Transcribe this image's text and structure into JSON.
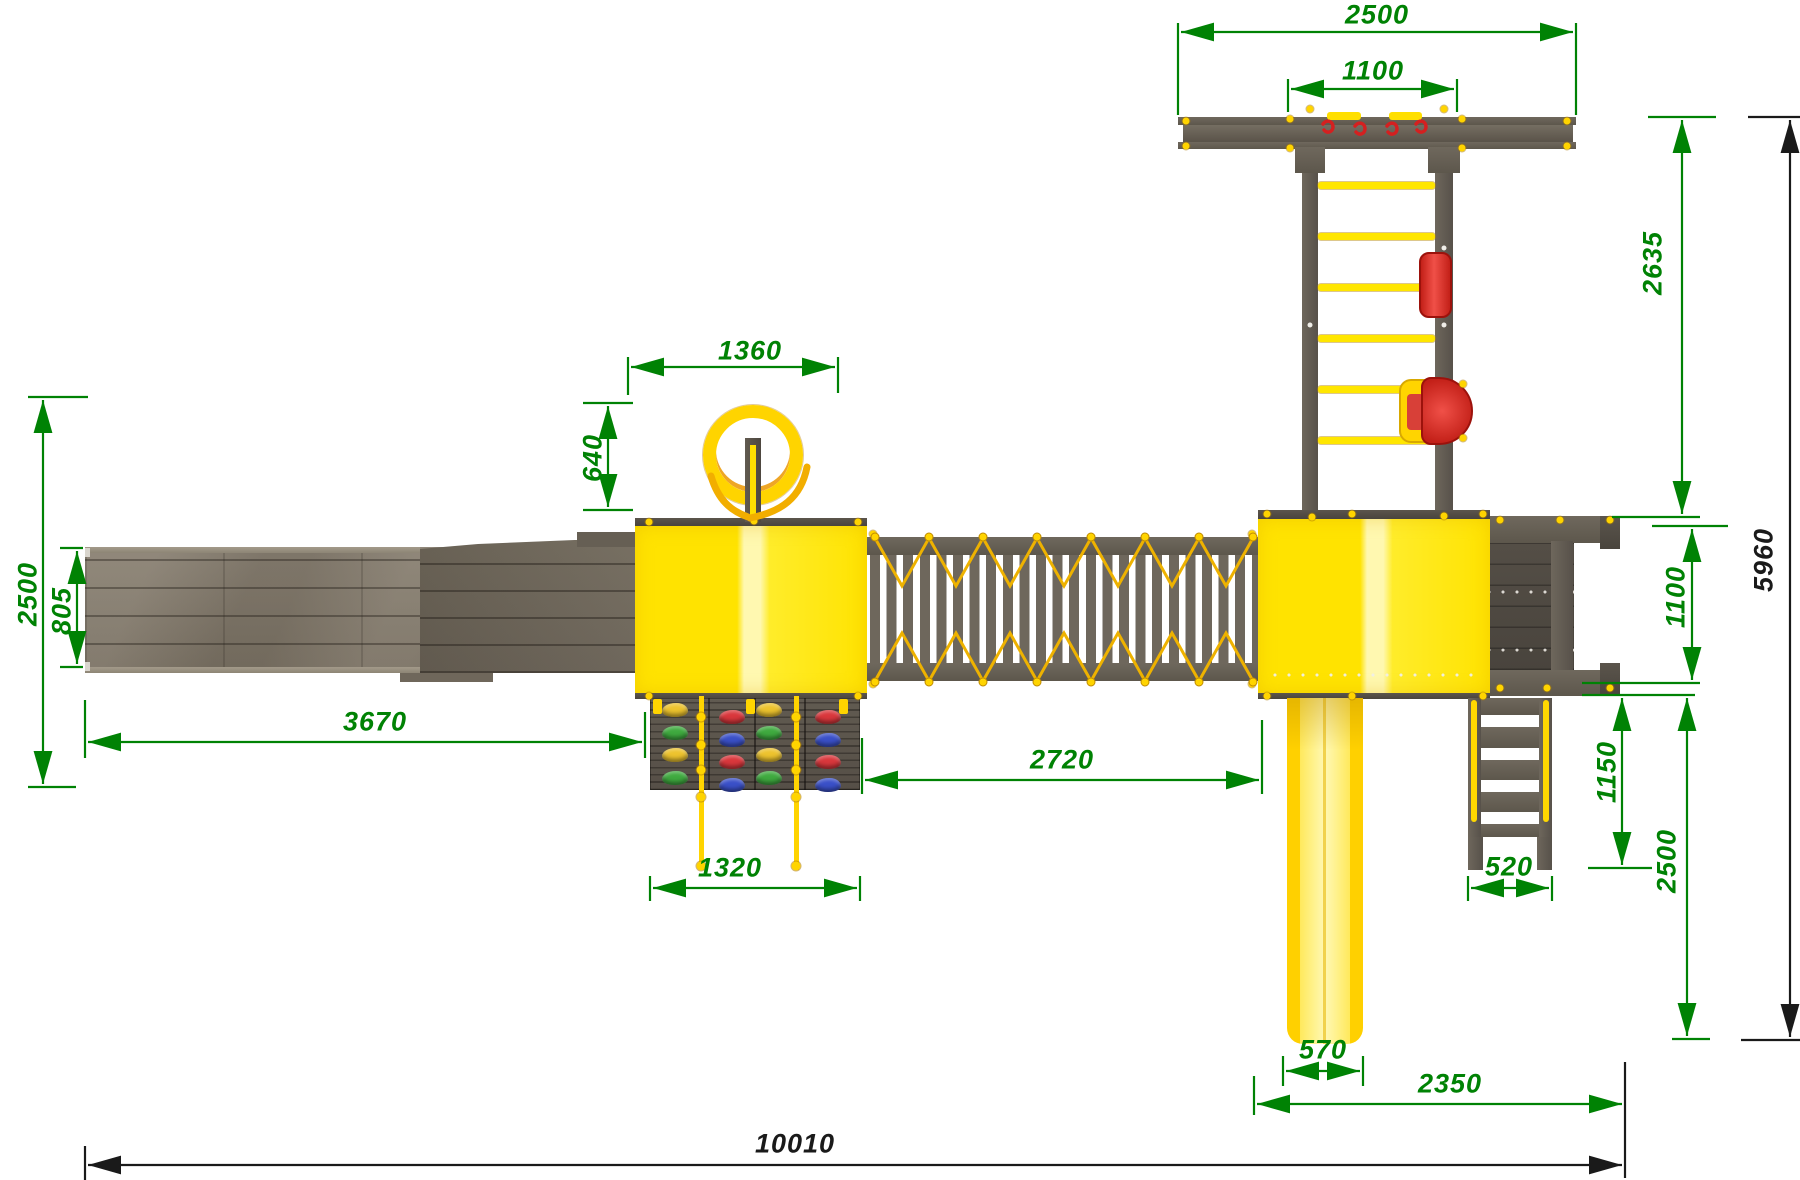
{
  "drawing": {
    "type": "playground-complex-top-view",
    "units": "mm",
    "background": "#ffffff"
  },
  "palette": {
    "dim-green": "#008204",
    "dim-black": "#1a1a1a",
    "wood": "#7d7567",
    "wood-dark": "#5d574e",
    "wood-darker": "#4e4942",
    "yellow": "#ffe600",
    "yellow-deep": "#ffd400",
    "yellow-pale": "#fff6a0",
    "orange": "#f0ae00",
    "red": "#e23530",
    "red-dark": "#a81410",
    "hold-yellow": "#edc32e",
    "hold-green": "#3faa3f",
    "hold-red": "#d9373c",
    "hold-blue": "#3a50c8"
  },
  "dimensions": {
    "swing_beam_width": "2500",
    "swing_hanger_span": "1100",
    "swing_ladder_length": "2635",
    "ring_beam_span": "1360",
    "ring_offset": "640",
    "left_module_depth": "2500",
    "ramp_width": "805",
    "ramp_length": "3670",
    "climb_wall_width": "1320",
    "bridge_length": "2720",
    "balcony_depth": "1100",
    "stairs_length": "1150",
    "stairs_width": "520",
    "right_module_depth": "2500",
    "slide_width": "570",
    "right_module_length": "2350",
    "total_length": "10010",
    "total_depth": "5960"
  },
  "climbing_wall": {
    "columns": [
      {
        "holds": [
          "yellow",
          "green",
          "yellow",
          "green"
        ]
      },
      {
        "holds": [
          "red",
          "blue",
          "red",
          "blue"
        ]
      },
      {
        "holds": [
          "yellow",
          "green",
          "yellow",
          "green"
        ]
      },
      {
        "holds": [
          "red",
          "blue",
          "red",
          "blue"
        ]
      }
    ]
  },
  "swing_ladder": {
    "rung_count": 6
  }
}
